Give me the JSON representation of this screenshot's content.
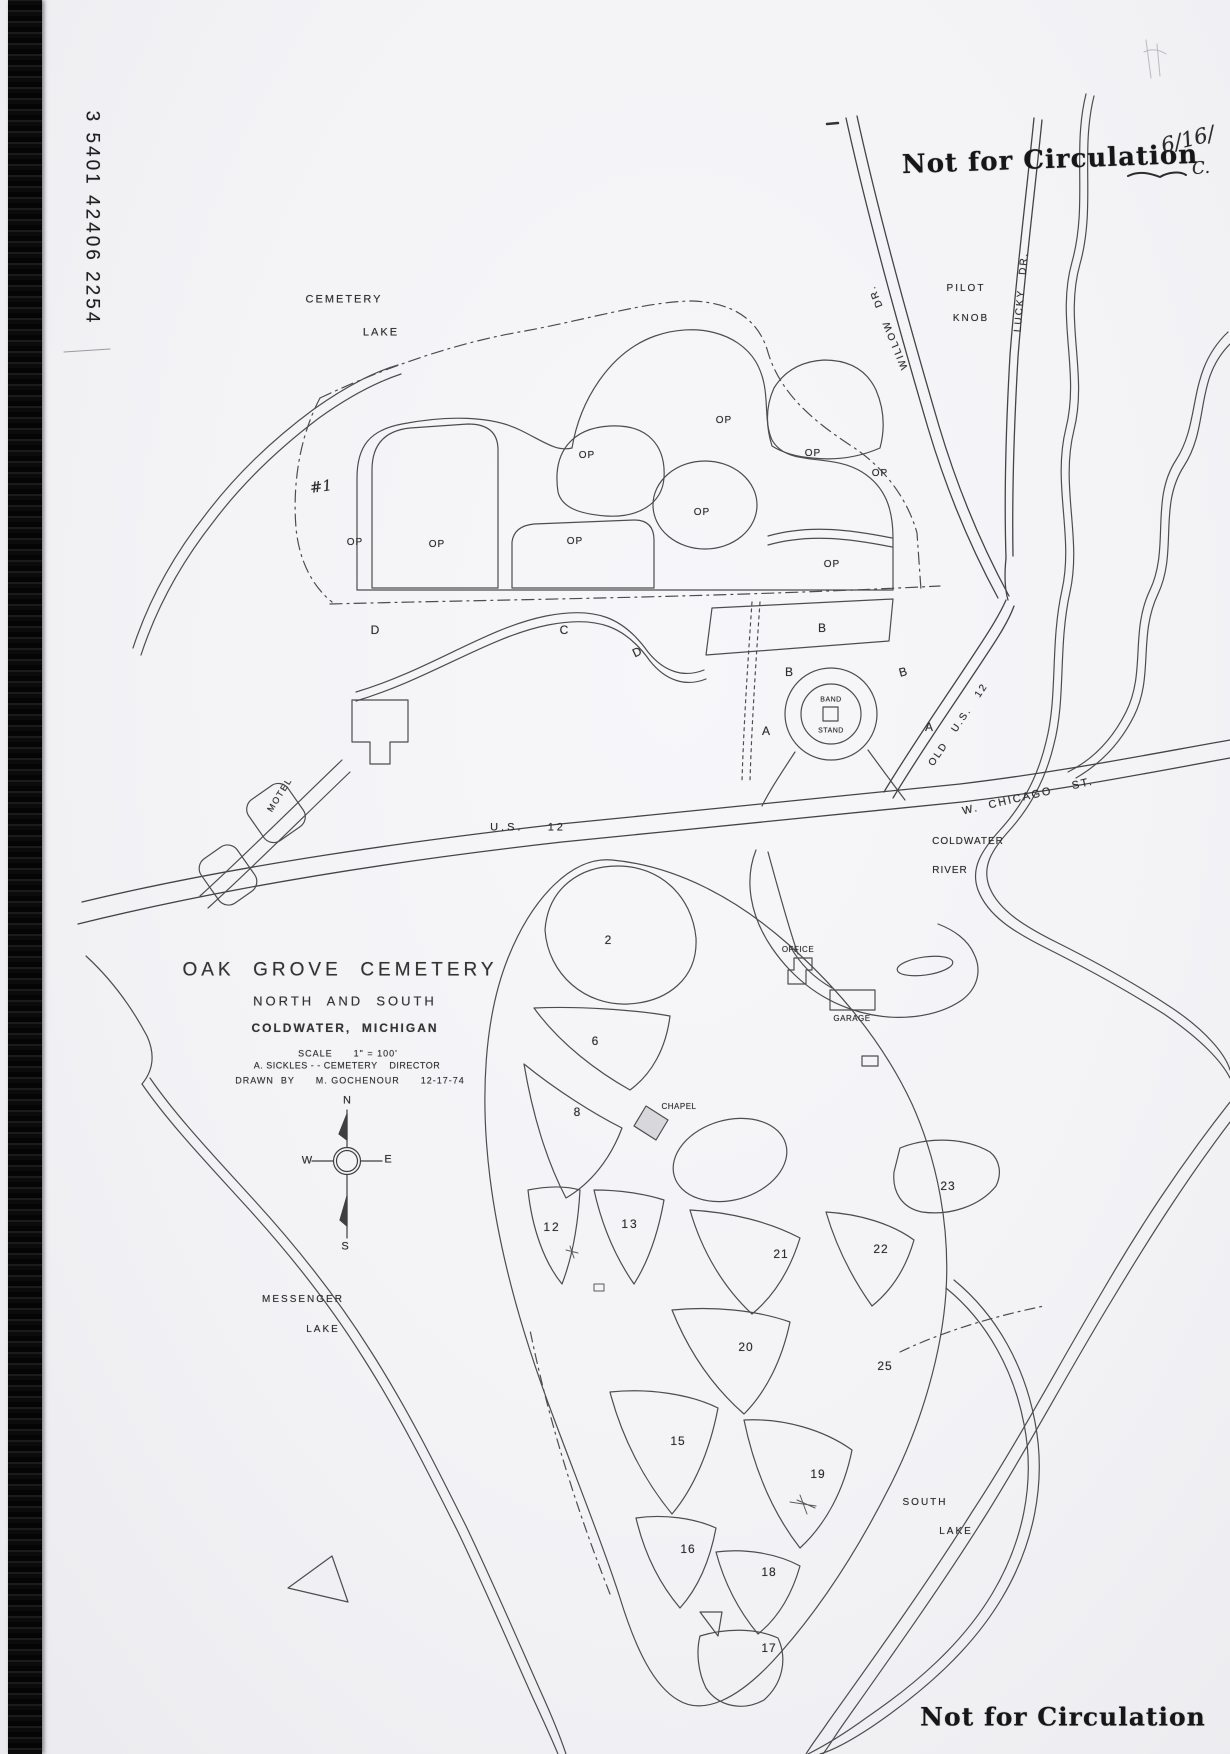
{
  "stamps": {
    "top_right": "Not for Circulation",
    "bottom_right": "Not for Circulation"
  },
  "annotations": {
    "date": "6/16/",
    "initial": "C.",
    "number_one": "#1"
  },
  "spine": {
    "accession_number": "3 5401 42406 2254"
  },
  "title_block": {
    "title": "OAK  GROVE  CEMETERY",
    "subtitle": "NORTH  AND  SOUTH",
    "city": "COLDWATER,  MICHIGAN",
    "scale_line": "SCALE      1\" = 100'",
    "director_line": "A. SICKLES - - CEMETERY    DIRECTOR",
    "drawn_line": "DRAWN  BY      M. GOCHENOUR      12-17-74"
  },
  "compass": {
    "n": "N",
    "e": "E",
    "s": "S",
    "w": "W"
  },
  "water": {
    "cemetery_lake_1": "CEMETERY",
    "cemetery_lake_2": "LAKE",
    "messenger_lake_1": "MESSENGER",
    "messenger_lake_2": "LAKE",
    "south_lake_1": "SOUTH",
    "south_lake_2": "LAKE",
    "coldwater_river_1": "COLDWATER",
    "coldwater_river_2": "RIVER",
    "pilot_knob_1": "PILOT",
    "pilot_knob_2": "KNOB"
  },
  "roads": {
    "us12": "U.S.    12",
    "old_us12": "OLD   U.S.   12",
    "w_chicago_st": "W.  CHICAGO    ST.",
    "willow_dr": "WILLOW   DR.",
    "lucky_dr": "LUCKY   DR.",
    "motel": "MOTEL"
  },
  "buildings": {
    "band_1": "BAND",
    "band_2": "STAND",
    "office": "OFFICE",
    "garage": "GARAGE",
    "chapel": "CHAPEL"
  },
  "sections": {
    "op": [
      "OP",
      "OP",
      "OP",
      "OP",
      "OP",
      "OP",
      "OP",
      "OP",
      "OP"
    ],
    "letters": {
      "d1": "D",
      "c": "C",
      "d2": "D",
      "b1": "B",
      "b2": "B",
      "b3": "B",
      "a1": "A",
      "a2": "A"
    },
    "numbers": {
      "n2": "2",
      "n6": "6",
      "n8": "8",
      "n12": "12",
      "n13": "13",
      "n15": "15",
      "n16": "16",
      "n17": "17",
      "n18": "18",
      "n19": "19",
      "n20": "20",
      "n21": "21",
      "n22": "22",
      "n23": "23",
      "n25": "25"
    }
  },
  "colors": {
    "ink": "#4a4a4a",
    "stamp_ink": "#161616"
  }
}
